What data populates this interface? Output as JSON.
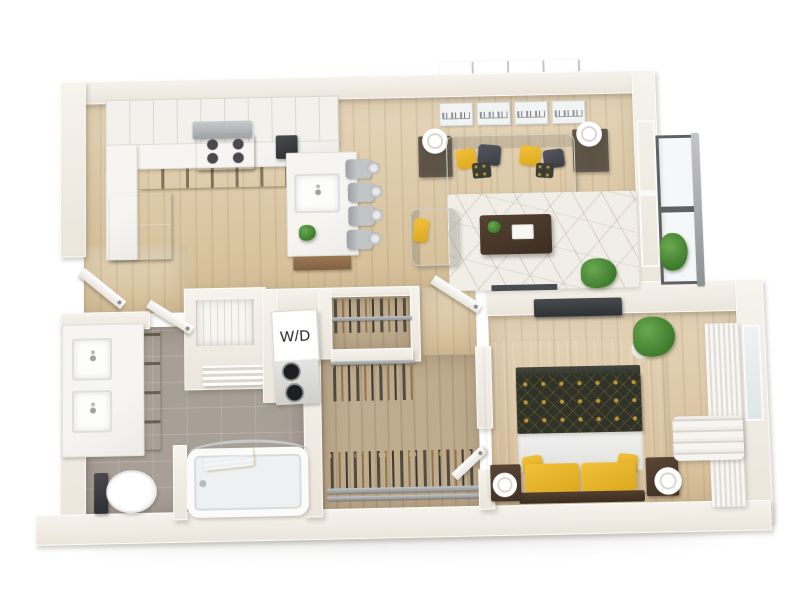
{
  "laundry": {
    "label": "W/D"
  },
  "palette": {
    "background": "#ffffff",
    "wall": "#efeae2",
    "wall_shadow": "#d9d2c6",
    "wood_floor": "#ddc7a1",
    "wood_floor_closet": "#bfab8d",
    "bathroom_tile": "#a89f97",
    "marble": "#f3f2ef",
    "cabinet_wood": "#926f4c",
    "dark_wood": "#4a3a2c",
    "accent_yellow": "#e9b62e",
    "duvet_navy": "#2f332a",
    "duvet_gold": "#bd9331",
    "sofa": "#e9e9e6",
    "bedroom_rug": "#c6cacc",
    "living_rug": "#f1eee7",
    "appliance_black": "#232326",
    "metal": "#a9adaf",
    "plant_green": "#4c8a38",
    "tv": "#3b3f42"
  },
  "objects": {
    "kitchen": [
      "upper-cabinets",
      "range-hood",
      "cooktop",
      "counter",
      "lower-cabinets",
      "refrigerator",
      "coffee-maker",
      "island",
      "island-sink",
      "bar-stools",
      "plant"
    ],
    "living_room": [
      "wall-art-panels",
      "table-lamps",
      "end-tables",
      "sofa",
      "throw-pillows",
      "area-rug",
      "coffee-table",
      "armchair",
      "floor-plant",
      "window",
      "balcony-railing",
      "balcony-plant",
      "console"
    ],
    "bathroom": [
      "double-vanity",
      "sinks",
      "vanity-drawers",
      "toilet",
      "bathtub",
      "towel",
      "shower-rod",
      "door"
    ],
    "laundry_closet": [
      "stacked-washer-dryer"
    ],
    "closet": [
      "hanging-rods",
      "clothes",
      "door"
    ],
    "bedroom": [
      "bed",
      "duvet",
      "sheet",
      "pillows",
      "nightstands",
      "lamps",
      "area-rug",
      "tv",
      "plant",
      "window",
      "curtains",
      "door"
    ],
    "entry": [
      "entry-door",
      "coat-closet",
      "shelf"
    ]
  }
}
